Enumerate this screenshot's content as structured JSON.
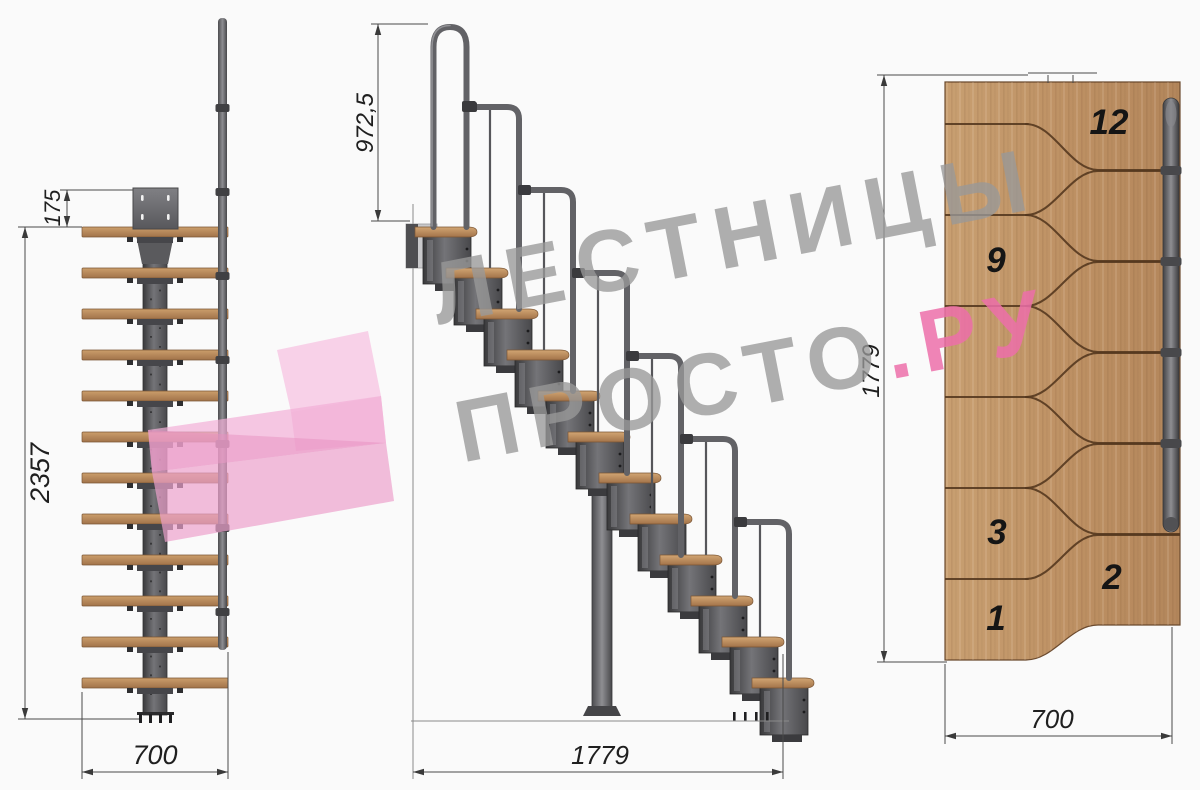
{
  "watermark": {
    "line1": "ЛЕСТНИЦЫ",
    "line2_gray": "ПРОСТО",
    "line2_pink": ".РУ",
    "gray": "#9a9a9a",
    "pink": "#ec6ea9"
  },
  "front_view": {
    "dim_top_offset": "175",
    "dim_total_height": "2357",
    "dim_width": "700"
  },
  "side_view": {
    "dim_handrail_height": "972,5",
    "dim_length": "1779"
  },
  "plan_view": {
    "dim_length": "1779",
    "dim_width": "700",
    "step_numbers": {
      "n12": "12",
      "n9": "9",
      "n3": "3",
      "n2": "2",
      "n1": "1"
    }
  },
  "colors": {
    "wood_light": "#c9a172",
    "wood_dark": "#a87a4e",
    "metal_dark": "#3f3f42",
    "metal_light": "#808084",
    "step_line": "#55381f",
    "dim_line": "#4a4a4a",
    "background": "#fafafa"
  }
}
